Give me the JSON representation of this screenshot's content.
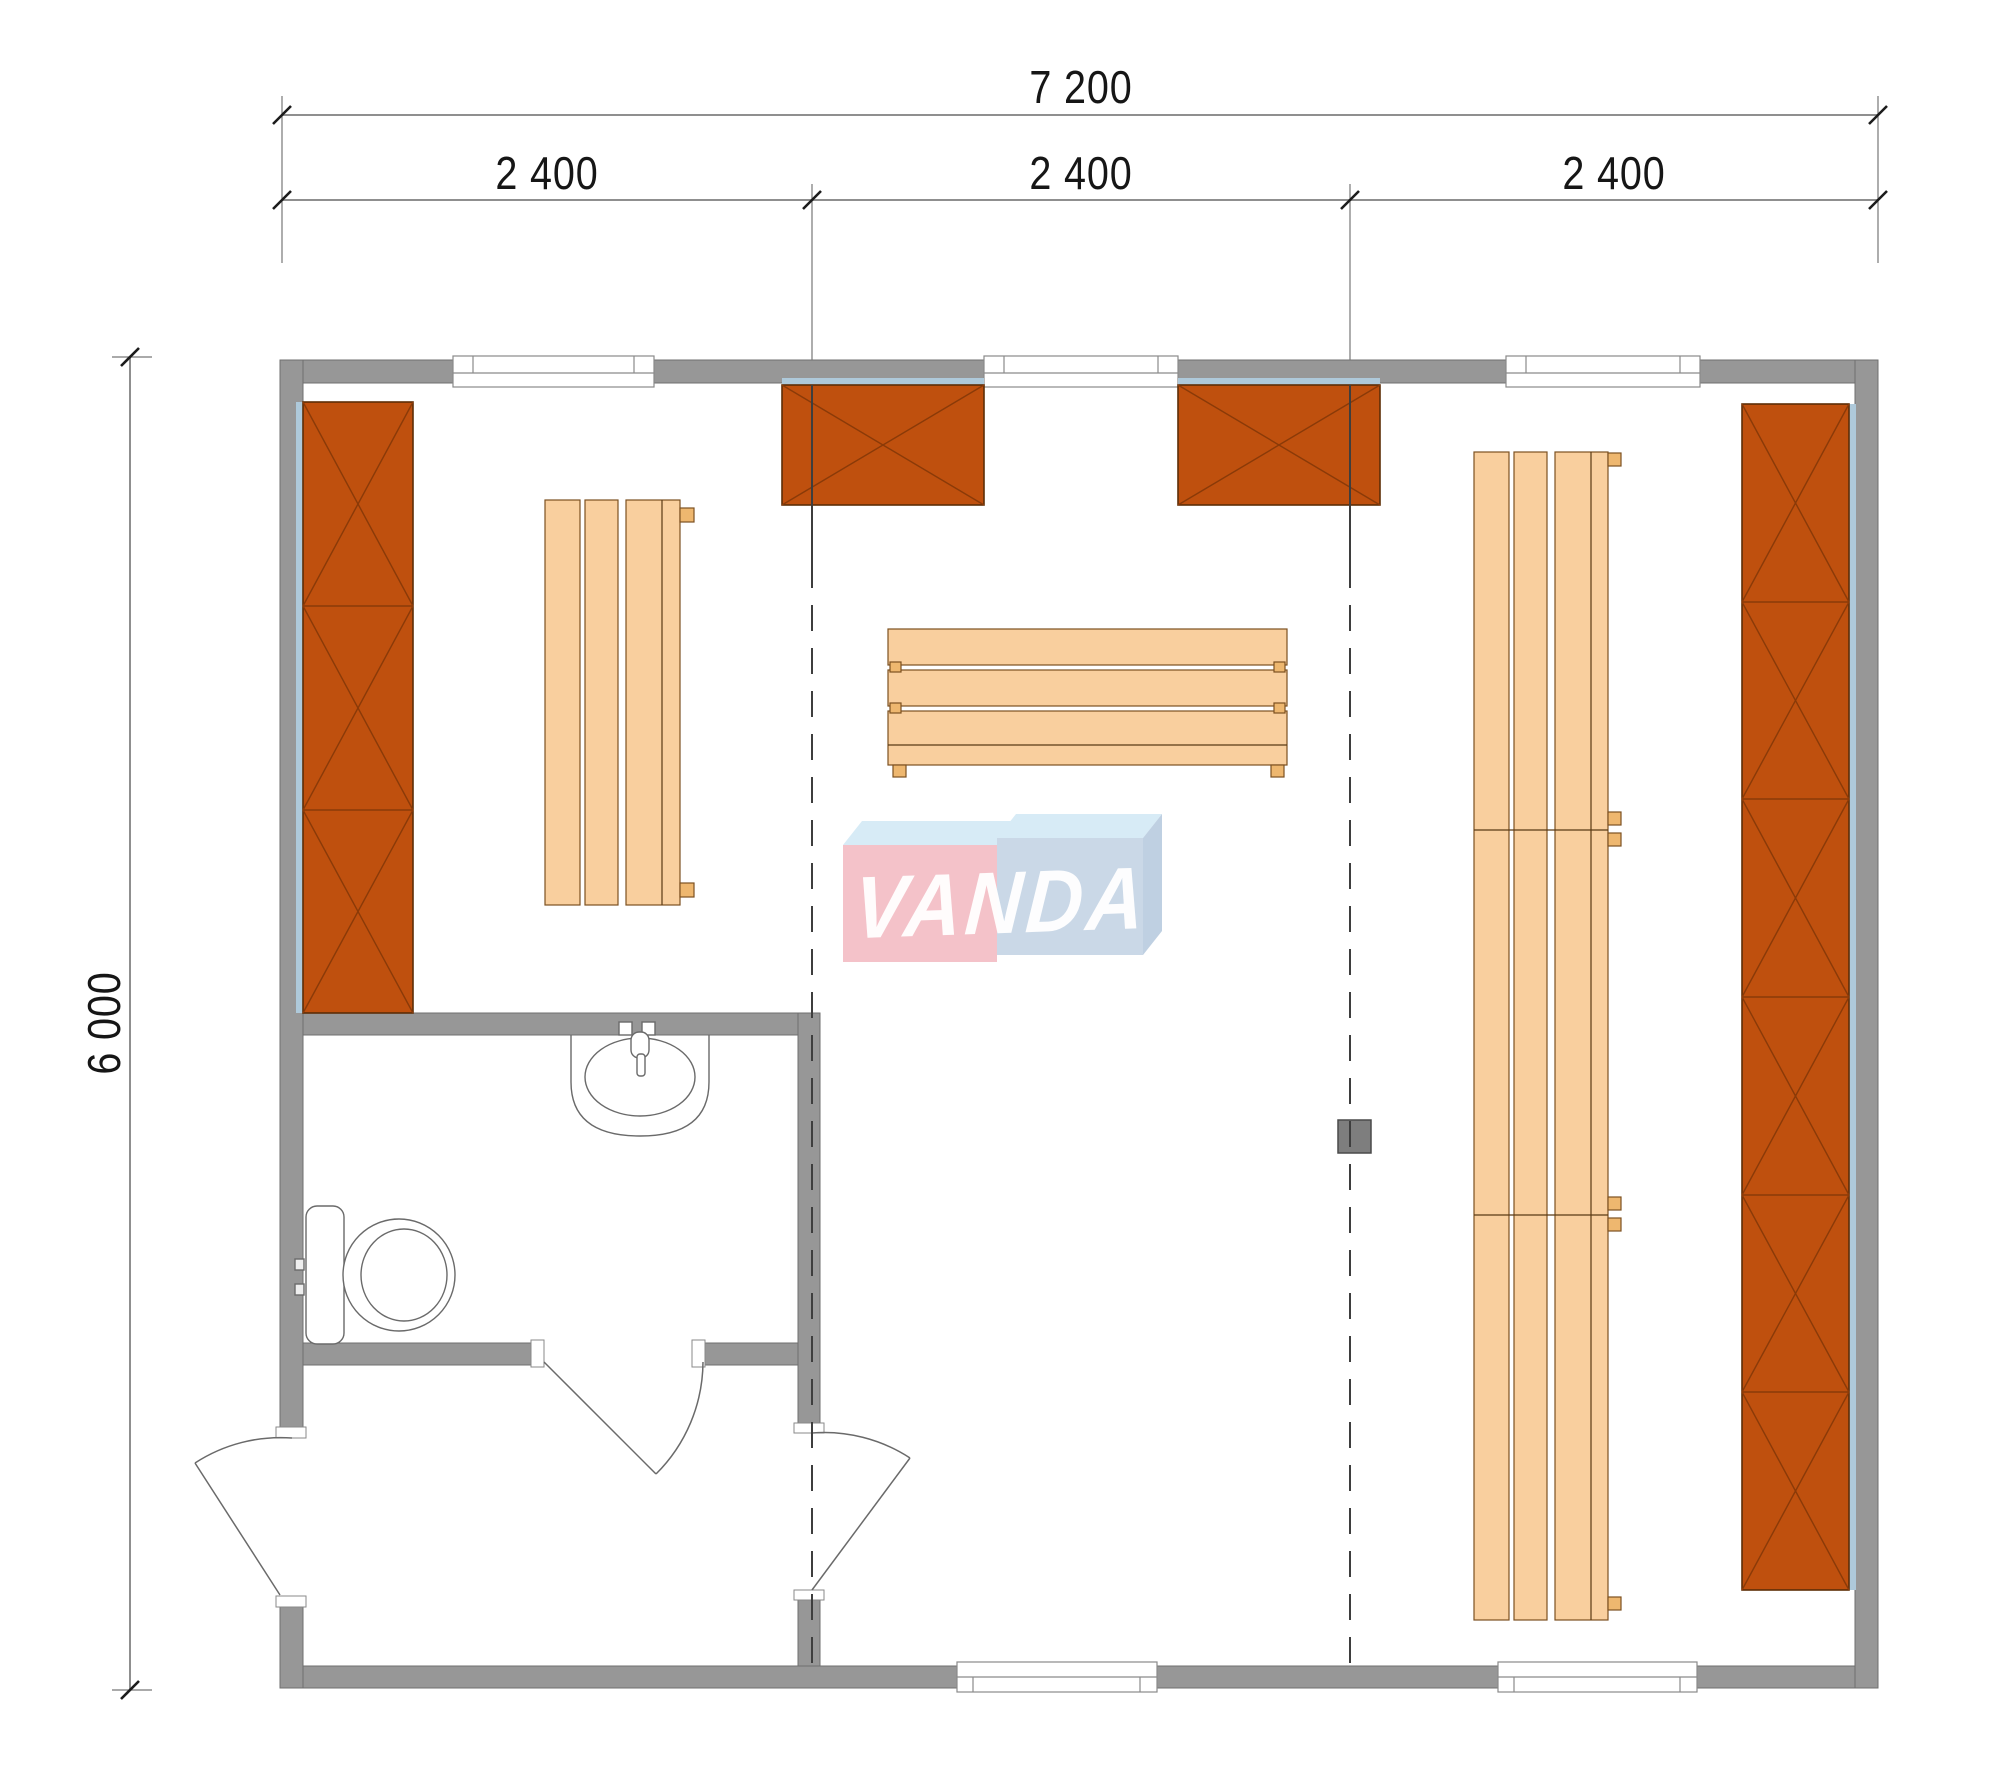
{
  "page": {
    "background": "#ffffff",
    "type": "architectural-floor-plan"
  },
  "dimensions": {
    "total_width": "7 200",
    "modules": [
      "2 400",
      "2 400",
      "2 400"
    ],
    "height": "6 000"
  },
  "watermark": {
    "text": "VANDA"
  },
  "colors": {
    "wall": "#979797",
    "wall_outline": "#6f6f6f",
    "cabinet_fill": "#bf500e",
    "cabinet_line": "#8a3a08",
    "bench_fill": "#f9cf9e",
    "bench_border": "#7c5121",
    "bench_tab": "#eeb76f",
    "panel_back": "#aec9da",
    "dash_line": "#3e3e3e",
    "dimension_line": "#8f8f8f",
    "dimension_text": "#161616",
    "fixture_line": "#6a6a6a",
    "post": "#7e7e7e",
    "watermark_pink": "#f4c2c9",
    "watermark_blue_top": "#d7ebf6",
    "watermark_blue_front": "#cad8e7",
    "watermark_blue_side": "#bfd0e2"
  }
}
